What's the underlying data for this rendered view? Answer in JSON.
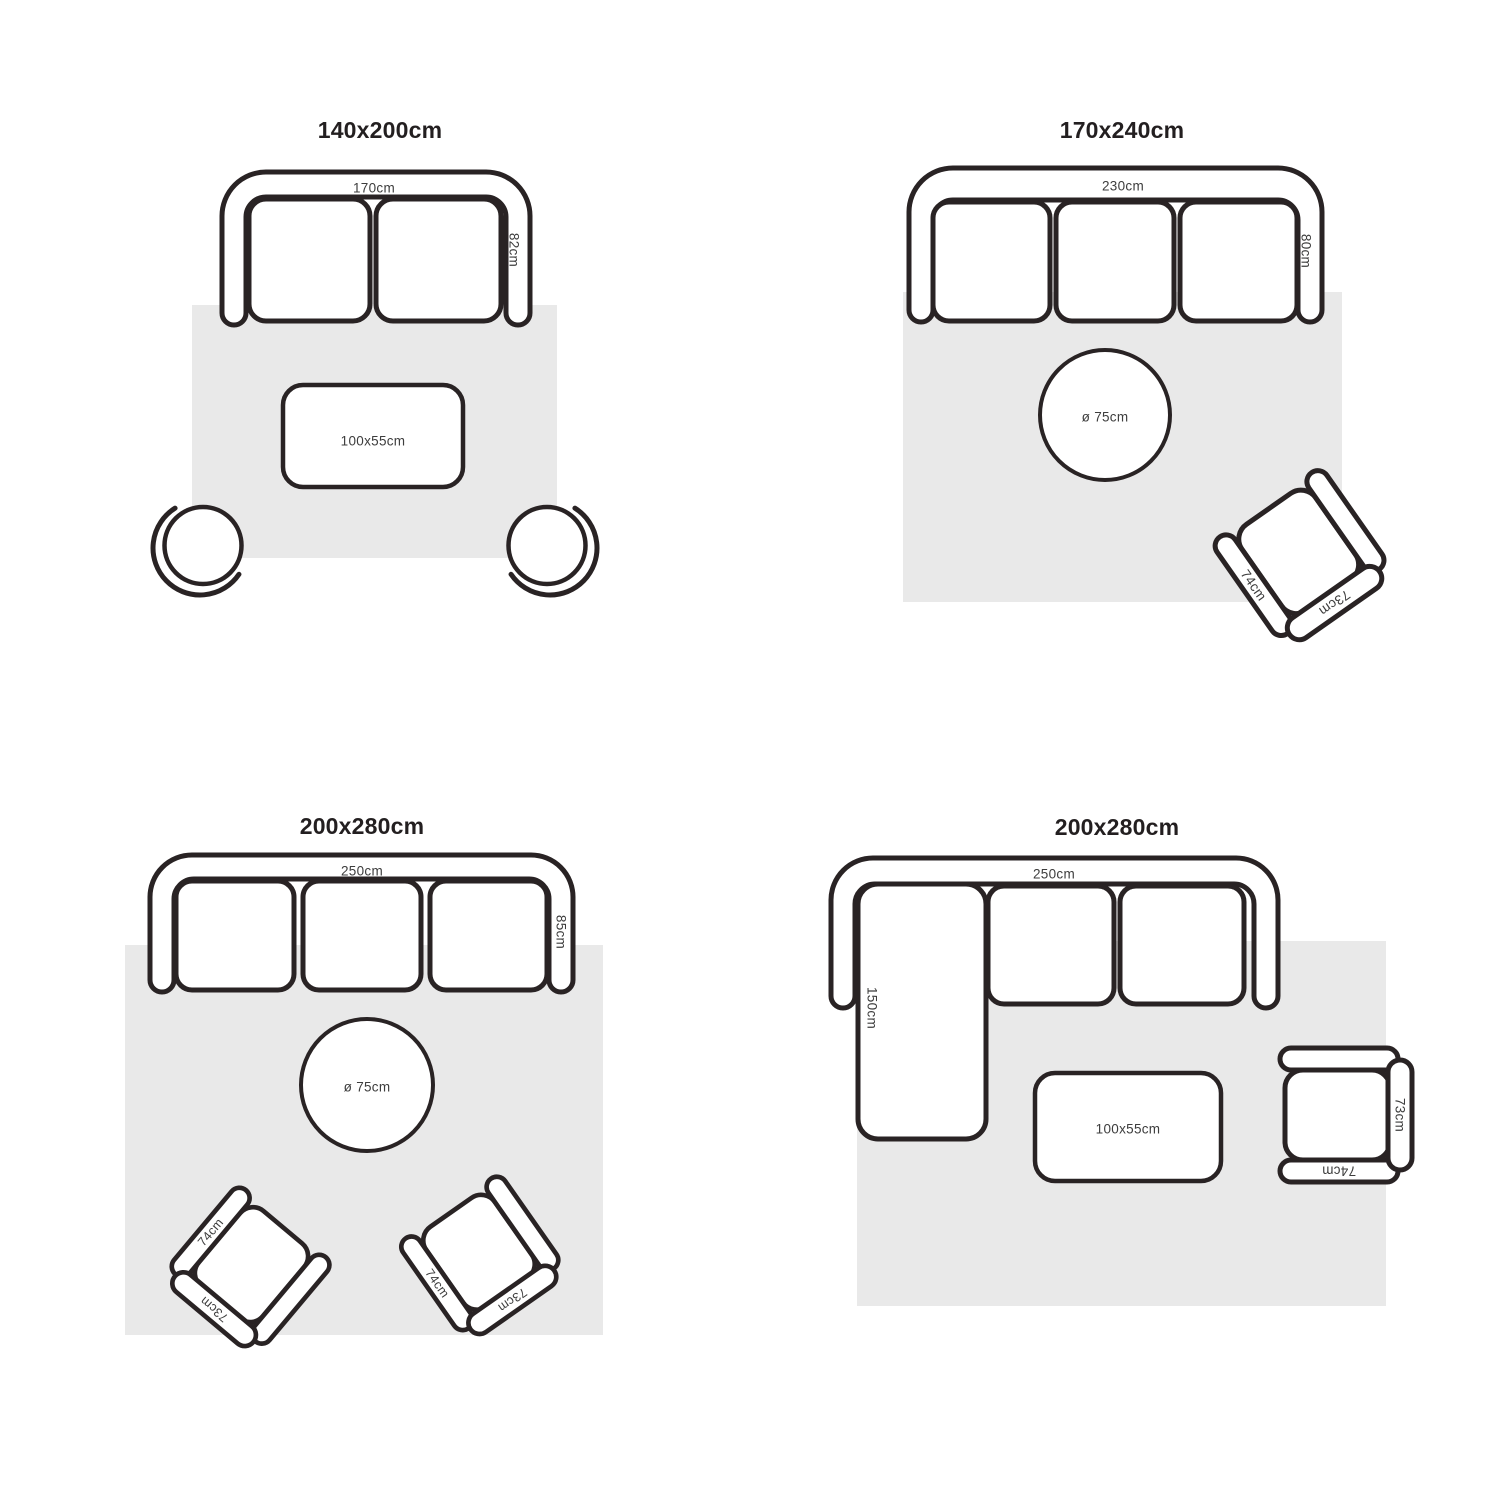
{
  "colors": {
    "outline": "#292324",
    "rug": "#e9e9e9",
    "label_text": "#3d3d3d",
    "title_text": "#231f20",
    "background": "#ffffff"
  },
  "panels": [
    {
      "title": "140x200cm",
      "rug_size": "140x200cm",
      "sofa": {
        "type": "2-seat sofa",
        "width_label": "170cm",
        "depth_label": "82cm"
      },
      "table": {
        "type": "rectangular coffee table",
        "label": "100x55cm"
      },
      "chairs": [
        {
          "type": "round swivel chair"
        },
        {
          "type": "round swivel chair"
        }
      ]
    },
    {
      "title": "170x240cm",
      "rug_size": "170x240cm",
      "sofa": {
        "type": "3-seat sofa",
        "width_label": "230cm",
        "depth_label": "80cm"
      },
      "table": {
        "type": "round side table",
        "label": "ø 75cm"
      },
      "chair": {
        "type": "armchair",
        "width_label": "74cm",
        "depth_label": "73cm"
      }
    },
    {
      "title": "200x280cm",
      "rug_size": "200x280cm",
      "sofa": {
        "type": "3-seat sofa",
        "width_label": "250cm",
        "depth_label": "85cm"
      },
      "table": {
        "type": "round side table",
        "label": "ø 75cm"
      },
      "chairs": [
        {
          "type": "armchair",
          "width_label": "74cm",
          "depth_label": "73cm"
        },
        {
          "type": "armchair",
          "width_label": "74cm",
          "depth_label": "73cm"
        }
      ]
    },
    {
      "title": "200x280cm",
      "rug_size": "200x280cm",
      "sofa": {
        "type": "sectional sofa with chaise",
        "width_label": "250cm",
        "chaise_label": "150cm"
      },
      "table": {
        "type": "rectangular coffee table",
        "label": "100x55cm"
      },
      "chair": {
        "type": "armchair",
        "width_label": "74cm",
        "depth_label": "73cm"
      }
    }
  ]
}
